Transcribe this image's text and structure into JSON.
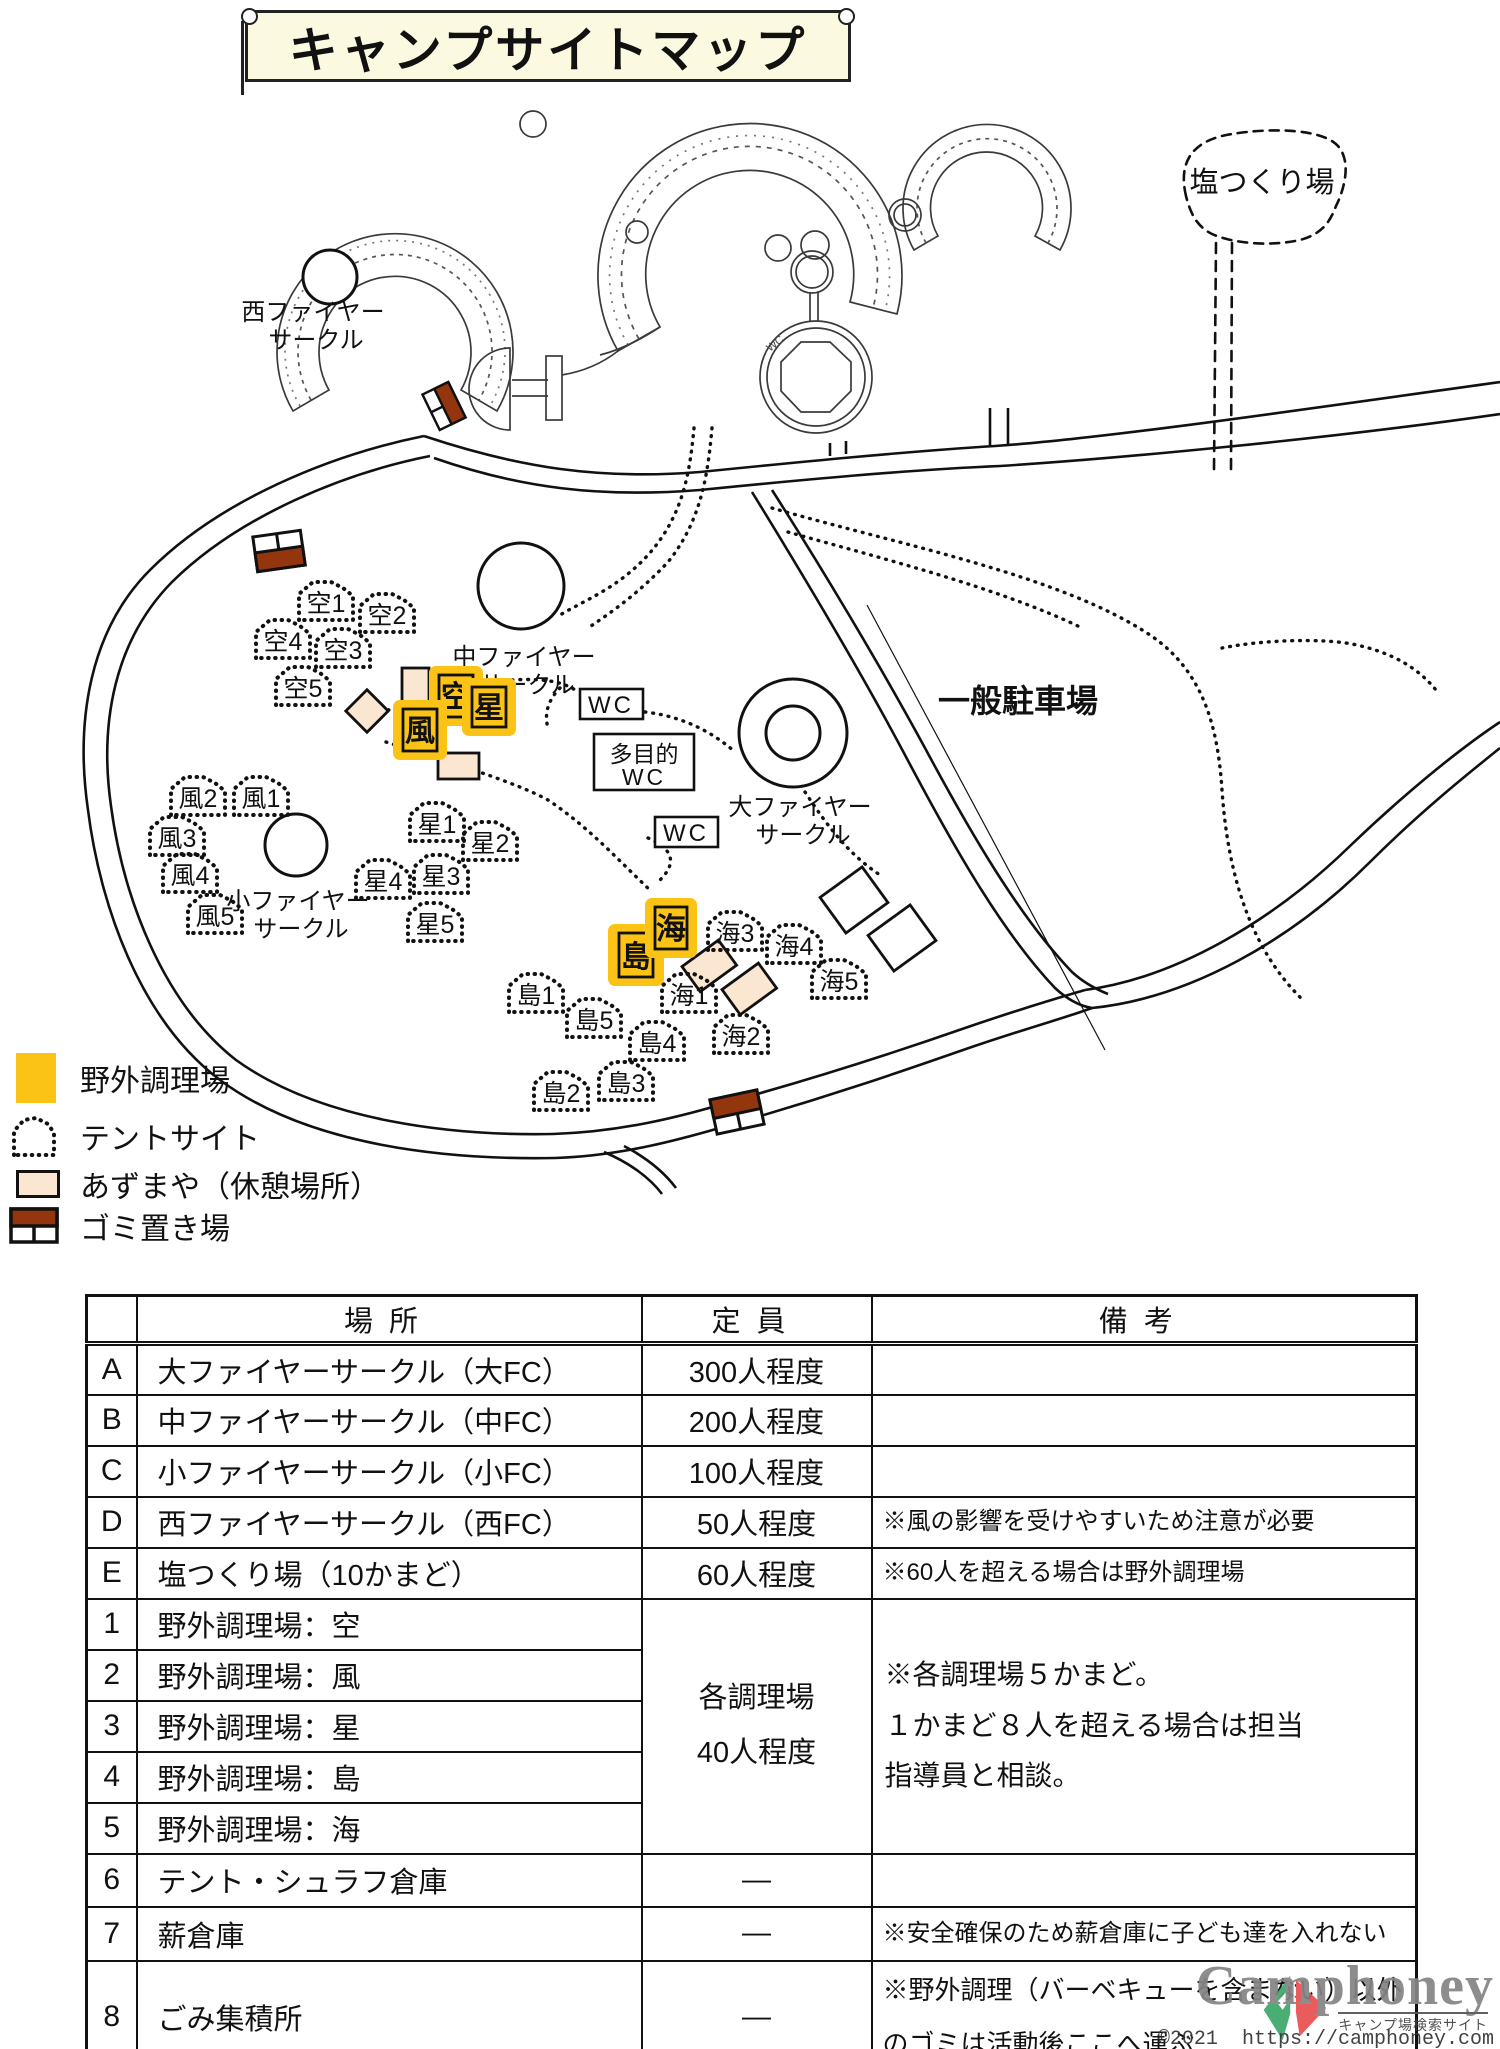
{
  "title": "キャンプサイトマップ",
  "map": {
    "labels": {
      "west_fc": [
        "西ファイヤー",
        "サークル"
      ],
      "mid_fc": [
        "中ファイヤー",
        "サークル"
      ],
      "big_fc": [
        "大ファイヤー",
        "サークル"
      ],
      "small_fc": [
        "小ファイヤー",
        "サークル"
      ],
      "parking": "一般駐車場",
      "salt": "塩つくり場",
      "wc1": "WC",
      "wc2": "WC",
      "multi_wc": [
        "多目的",
        "WC"
      ],
      "bldg_wc": "WC"
    },
    "cook": {
      "sora": "空",
      "kaze": "風",
      "hoshi": "星",
      "shima": "島",
      "umi": "海"
    },
    "tents": [
      {
        "label": "空1"
      },
      {
        "label": "空2"
      },
      {
        "label": "空3"
      },
      {
        "label": "空4"
      },
      {
        "label": "空5"
      },
      {
        "label": "風1"
      },
      {
        "label": "風2"
      },
      {
        "label": "風3"
      },
      {
        "label": "風4"
      },
      {
        "label": "風5"
      },
      {
        "label": "星1"
      },
      {
        "label": "星2"
      },
      {
        "label": "星3"
      },
      {
        "label": "星4"
      },
      {
        "label": "星5"
      },
      {
        "label": "島1"
      },
      {
        "label": "島2"
      },
      {
        "label": "島3"
      },
      {
        "label": "島4"
      },
      {
        "label": "島5"
      },
      {
        "label": "海1"
      },
      {
        "label": "海2"
      },
      {
        "label": "海3"
      },
      {
        "label": "海4"
      },
      {
        "label": "海5"
      }
    ]
  },
  "legend": {
    "items": [
      {
        "label": "野外調理場"
      },
      {
        "label": "テントサイト"
      },
      {
        "label": "あずまや（休憩場所）"
      },
      {
        "label": "ゴミ置き場"
      }
    ]
  },
  "table": {
    "headers": {
      "place": "場所",
      "capacity": "定員",
      "note": "備考"
    },
    "rows": [
      {
        "id": "A",
        "place": "大ファイヤーサークル（大FC）",
        "capacity": "300人程度",
        "note": ""
      },
      {
        "id": "B",
        "place": "中ファイヤーサークル（中FC）",
        "capacity": "200人程度",
        "note": ""
      },
      {
        "id": "C",
        "place": "小ファイヤーサークル（小FC）",
        "capacity": "100人程度",
        "note": ""
      },
      {
        "id": "D",
        "place": "西ファイヤーサークル（西FC）",
        "capacity": "50人程度",
        "note": "※風の影響を受けやすいため注意が必要"
      },
      {
        "id": "E",
        "place": "塩つくり場（10かまど）",
        "capacity": "60人程度",
        "note": "※60人を超える場合は野外調理場"
      },
      {
        "id": "1",
        "place": "野外調理場：空"
      },
      {
        "id": "2",
        "place": "野外調理場：風"
      },
      {
        "id": "3",
        "place": "野外調理場：星"
      },
      {
        "id": "4",
        "place": "野外調理場：島"
      },
      {
        "id": "5",
        "place": "野外調理場：海"
      },
      {
        "id": "6",
        "place": "テント・シュラフ倉庫",
        "capacity": "—",
        "note": ""
      },
      {
        "id": "7",
        "place": "薪倉庫",
        "capacity": "—",
        "note": "※安全確保のため薪倉庫に子ども達を入れない"
      },
      {
        "id": "8",
        "place": "ごみ集積所",
        "capacity": "—",
        "note_lines": [
          "※野外調理（バーベキューを含まない）以外",
          "のゴミは活動後ここへ運ぶ"
        ]
      }
    ],
    "merged_capacity": [
      "各調理場",
      "40人程度"
    ],
    "merged_note": [
      "※各調理場５かまど。",
      "１かまど８人を超える場合は担当",
      "指導員と相談。"
    ]
  },
  "watermark": {
    "brand": "Camphoney",
    "tagline": "キャンプ場検索サイト",
    "copyright": "©2021",
    "url": "https://camphoney.com"
  },
  "colors": {
    "cook_yellow": "#fcc317",
    "azumaya_beige": "#fbe6d2",
    "garbage_brown": "#93350d",
    "banner_cream": "#fbf9e0"
  }
}
